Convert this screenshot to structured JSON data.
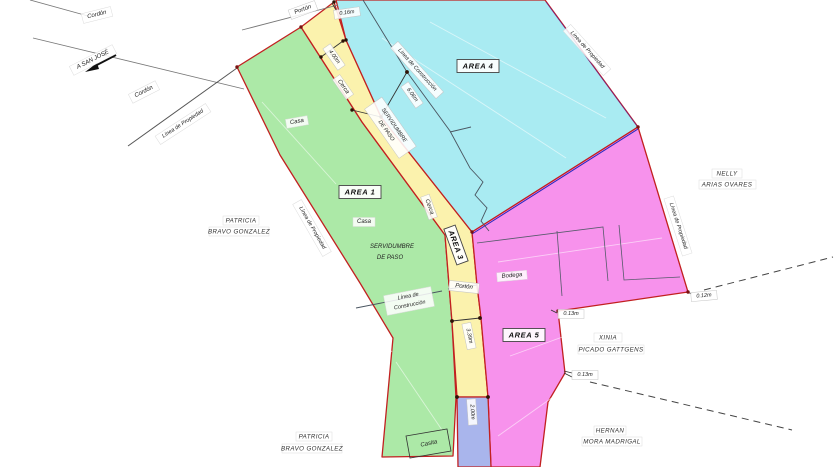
{
  "colors": {
    "area1_fill": "#ace9a7",
    "strip_fill": "#fbf2ad",
    "area4_fill": "#a9ebf2",
    "area5_fill": "#f792ec",
    "strip2_fill": "#a9b5ec",
    "boundary": "#c22020",
    "cyan_magenta_divider": "#2a2ac0"
  },
  "areas": {
    "area1": "AREA 1",
    "area3": "AREA 3",
    "area4": "AREA 4",
    "area5": "AREA 5"
  },
  "owners": {
    "patricia_upper": [
      "PATRICIA",
      "BRAVO GONZALEZ"
    ],
    "patricia_lower": [
      "PATRICIA",
      "BRAVO GONZALEZ"
    ],
    "nelly": [
      "NELLY",
      "ARIAS OVARES"
    ],
    "xinia": [
      "XINIA",
      "PICADO GATTGENS"
    ],
    "hernan": [
      "HERNAN",
      "MORA MADRIGAL"
    ]
  },
  "road": {
    "destination": "A SAN JOSÉ"
  },
  "labels": {
    "cordon_a": "Cordón",
    "cordon_b": "Cordón",
    "property_line_a": "Línea de Propiedad",
    "property_line_b": "Línea de Propiedad",
    "property_line_c": "Línea de Propiedad",
    "property_line_d": "Línea de Propiedad",
    "construction_line_a": "Línea de Construcción",
    "construction_line_b1": "Línea de",
    "construction_line_b2": "Construcción",
    "cerca_a": "Cerca",
    "cerca_b": "Cerca",
    "porton_a": "Portón",
    "porton_b": "Portón",
    "casa_a": "Casa",
    "casa_b": "Casa",
    "casita": "Casita",
    "bodega": "Bodega",
    "servidumbre_strip_1": "SERVIDUMBRE",
    "servidumbre_strip_2": "DE PASO",
    "servidumbre_green_1": "SERVIDUMBRE",
    "servidumbre_green_2": "DE PASO"
  },
  "measurements": {
    "gate_top": "0.16m",
    "strip_top": "4.00m",
    "construction_offset": "6.06m",
    "strip_lower": "3.39m",
    "strip_bottom": "2.00m",
    "east_corner": "0.12m",
    "south_a": "0.13m",
    "south_b": "0.13m"
  }
}
